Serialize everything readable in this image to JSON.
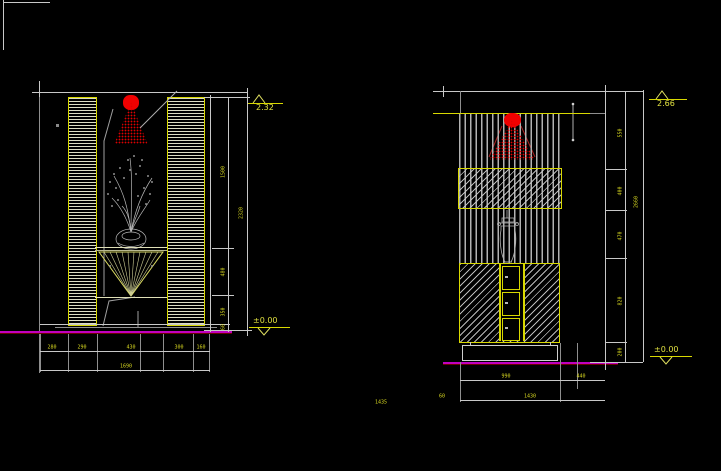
{
  "canvas": {
    "bg": "#000000"
  },
  "left_view": {
    "title": "plant-niche-elevation",
    "elev_top": "2.32",
    "elev_bottom": "±0.00",
    "bottom_dims": [
      "280",
      "290",
      "430",
      "300",
      "160"
    ],
    "bottom_total": "1690",
    "side_dims": [
      "1500",
      "480",
      "350",
      "60"
    ],
    "side_total": "2320"
  },
  "right_view": {
    "title": "shrine-cabinet-elevation",
    "elev_top": "2.66",
    "elev_bottom": "±0.00",
    "bottom_dims": [
      "990",
      "440"
    ],
    "bottom_total": "1430",
    "side_dims": [
      "550",
      "400",
      "470",
      "820",
      "200"
    ],
    "side_total": "2660",
    "stray_dim": "60"
  },
  "floating_dim": "1435",
  "colors": {
    "dim_text": "#d8d820",
    "line": "#c8c8c8",
    "accent_yellow": "#d8d800",
    "baseline_magenta": "#c000c0",
    "light_red": "#f00000"
  }
}
